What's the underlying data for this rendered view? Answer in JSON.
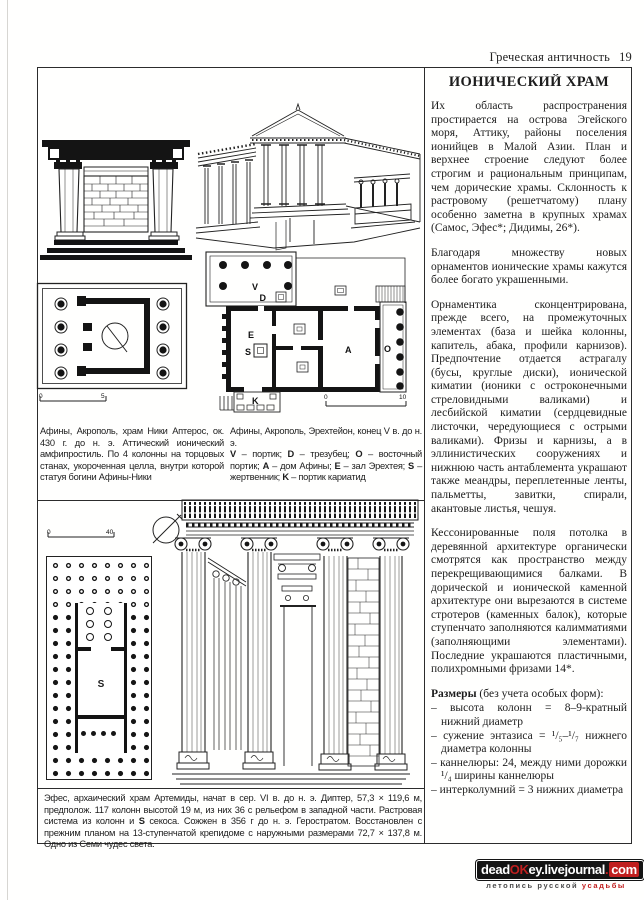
{
  "header": {
    "title": "Греческая античность",
    "page_number": "19"
  },
  "article": {
    "title": "ИОНИЧЕСКИЙ ХРАМ",
    "paragraphs": [
      "Их область распространения простирается на острова Эгейского моря, Аттику, районы поселения ионийцев в Малой Азии. План и верхнее строение следуют более строгим и рациональным принципам, чем дорические храмы. Склонность к растровому (решетчатому) плану особенно заметна в крупных храмах (Самос, Эфес*; Дидимы, 26*).",
      "Благодаря множеству новых орнаментов ионические храмы кажутся более богато украшенными.",
      "Орнаментика сконцентрирована, прежде всего, на промежуточных элементах (база и шейка колонны, капитель, абака, профили карнизов). Предпочтение отдается астрагалу (бусы, круглые диски), ионической киматии (ионики с остроконечными стреловидными валиками) и лесбийской киматии (сердцевидные листочки, чередующиеся с острыми валиками). Фризы и карнизы, а в эллинистических сооружениях и нижнюю часть антаблемента украшают также меандры, переплетенные ленты, пальметты, завитки, спирали, акантовые листья, чешуя.",
      "Кессонированные поля потолка в деревянной архитектуре органически смотрятся как пространство между перекрещивающимися балками. В дорической и ионической каменной архитектуре они вырезаются в системе стротеров (каменных балок), которые ступенчато заполняются калимматиями (заполняющими элементами). Последние украшаются пластичными, полихромными фризами 14*."
    ],
    "sizes_heading": "Размеры",
    "sizes_suffix": " (без учета особых форм):",
    "sizes_items": [
      "– высота колонн = 8–9-кратный нижний диаметр",
      "– сужение энтазиса = ¹/₅–¹/₇ нижнего диаметра колонны",
      "– каннелюры: 24, между ними дорожки ¹/₄ ширины каннелюры",
      "– интерколумний = 3 нижних диаметра"
    ]
  },
  "figures": {
    "nike": {
      "caption": "Афины, Акрополь, храм Ники Аптерос, ок. 430 г. до н. э. Аттический ионический амфипростиль. По 4 колонны на торцовых станах, укороченная целла, внутри которой статуя богини Афины-Ники",
      "scale_start": "0",
      "scale_end": "5"
    },
    "erechtheion": {
      "caption_line1": "Афины, Акрополь, Эрехтейон, конец V в. до н. э.",
      "legend": [
        {
          "key": "V",
          "text": "– портик; "
        },
        {
          "key": "D",
          "text": "– трезубец; "
        },
        {
          "key": "O",
          "text": "– восточный портик; "
        },
        {
          "key": "A",
          "text": "– дом Афины; "
        },
        {
          "key": "E",
          "text": "– зал Эрехтея; "
        },
        {
          "key": "S",
          "text": "– жертвенник; "
        },
        {
          "key": "K",
          "text": "– портик кариатид"
        }
      ],
      "plan_labels": {
        "v": "V",
        "d": "D",
        "e": "E",
        "s": "S",
        "a": "A",
        "o": "O",
        "k": "K"
      },
      "scale_start": "0",
      "scale_end": "10"
    },
    "artemis": {
      "caption_part1": "Эфес, архаический храм Артемиды, начат в сер. VI в. до н. э. Диптер, 57,3 × 119,6 м, предполож. 117 колонн высотой 19 м, из них 36 с рельефом в западной части. Растровая система из колонн и ",
      "caption_bold": "S",
      "caption_part2": " секоса. Сожжен в 356 г до н. э. Геростратом. Восстановлен с прежним планом на 13-ступенчатой крепидоме с наружными размерами 72,7 × 137,8 м. Одно из Семи чудес света.",
      "plan_label_s": "S",
      "scale_start": "0",
      "scale_end": "40"
    }
  },
  "watermark": {
    "part1": "dead",
    "part2": "OK",
    "part3": "ey.livejournal",
    "dot": ".",
    "part4": "com",
    "subtitle_dark": "летопись русской ",
    "subtitle_red": "усадьбы",
    "accent_color": "#c01f1f"
  }
}
